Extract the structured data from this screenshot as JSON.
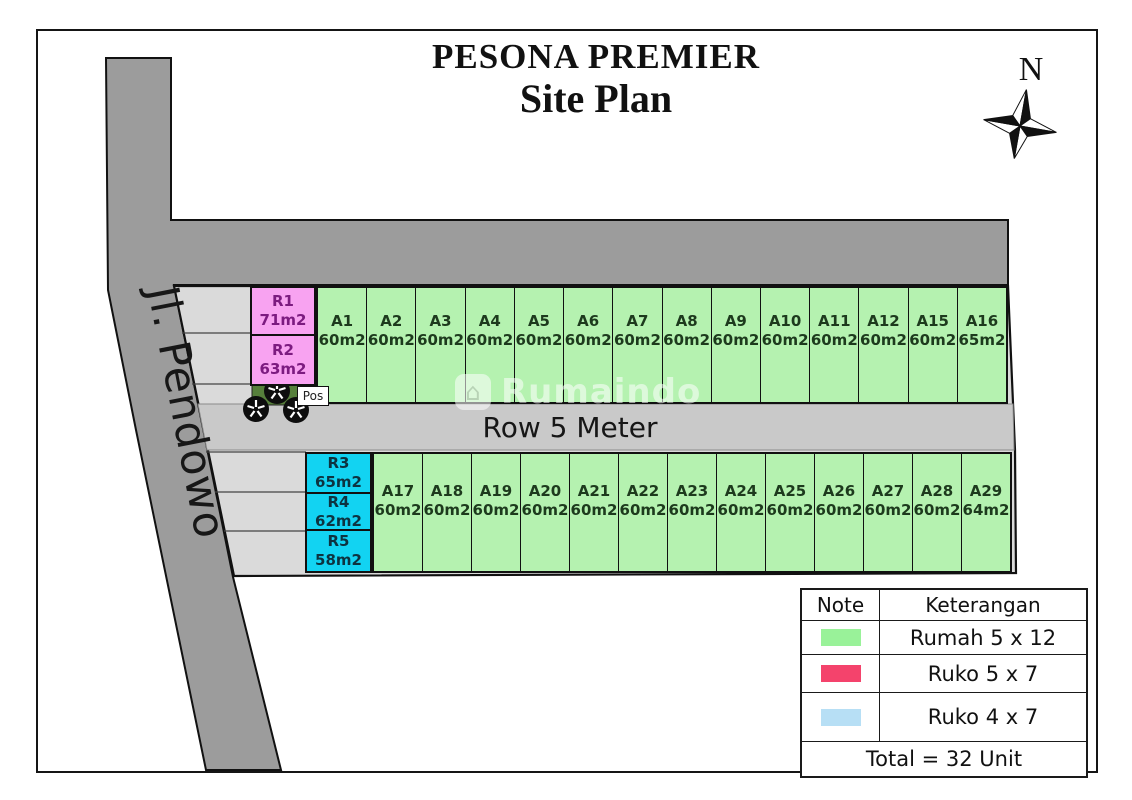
{
  "title": {
    "line1": "PESONA PREMIER",
    "line2": "Site Plan"
  },
  "compass": {
    "label": "N"
  },
  "roads": {
    "left_road_label": "Jl. Pendowo",
    "middle_road_label": "Row 5 Meter"
  },
  "watermark": {
    "text": "Rumaindo"
  },
  "site": {
    "pos_label": "Pos"
  },
  "plots": {
    "ruko_top": [
      {
        "id": "R1",
        "size": "71m2"
      },
      {
        "id": "R2",
        "size": "63m2"
      }
    ],
    "ruko_bottom": [
      {
        "id": "R3",
        "size": "65m2"
      },
      {
        "id": "R4",
        "size": "62m2"
      },
      {
        "id": "R5",
        "size": "58m2"
      }
    ],
    "row_top": [
      {
        "id": "A1",
        "size": "60m2"
      },
      {
        "id": "A2",
        "size": "60m2"
      },
      {
        "id": "A3",
        "size": "60m2"
      },
      {
        "id": "A4",
        "size": "60m2"
      },
      {
        "id": "A5",
        "size": "60m2"
      },
      {
        "id": "A6",
        "size": "60m2"
      },
      {
        "id": "A7",
        "size": "60m2"
      },
      {
        "id": "A8",
        "size": "60m2"
      },
      {
        "id": "A9",
        "size": "60m2"
      },
      {
        "id": "A10",
        "size": "60m2"
      },
      {
        "id": "A11",
        "size": "60m2"
      },
      {
        "id": "A12",
        "size": "60m2"
      },
      {
        "id": "A15",
        "size": "60m2"
      },
      {
        "id": "A16",
        "size": "65m2"
      }
    ],
    "row_bottom": [
      {
        "id": "A17",
        "size": "60m2"
      },
      {
        "id": "A18",
        "size": "60m2"
      },
      {
        "id": "A19",
        "size": "60m2"
      },
      {
        "id": "A20",
        "size": "60m2"
      },
      {
        "id": "A21",
        "size": "60m2"
      },
      {
        "id": "A22",
        "size": "60m2"
      },
      {
        "id": "A23",
        "size": "60m2"
      },
      {
        "id": "A24",
        "size": "60m2"
      },
      {
        "id": "A25",
        "size": "60m2"
      },
      {
        "id": "A26",
        "size": "60m2"
      },
      {
        "id": "A27",
        "size": "60m2"
      },
      {
        "id": "A28",
        "size": "60m2"
      },
      {
        "id": "A29",
        "size": "64m2"
      }
    ]
  },
  "legend": {
    "headers": [
      "Note",
      "Keterangan"
    ],
    "rows": [
      {
        "color": "#99f299",
        "label": "Rumah 5 x 12"
      },
      {
        "color": "#f4436c",
        "label": "Ruko 5 x 7"
      },
      {
        "color": "#b7dff5",
        "label": "Ruko 4 x 7"
      }
    ],
    "total": "Total = 32 Unit"
  },
  "colors": {
    "rumah_fill": "#b5f2b0",
    "rumah_text": "#1d3a1d",
    "ruko_pink_fill": "#f8a3f1",
    "ruko_pink_text": "#7c1b80",
    "ruko_cyan_fill": "#12d3f2",
    "ruko_cyan_text": "#0d3340",
    "road_dark": "#9c9c9c",
    "road_light": "#c9c9c9",
    "wedge_gray": "#dadada",
    "garden_green": "#567f3b"
  }
}
